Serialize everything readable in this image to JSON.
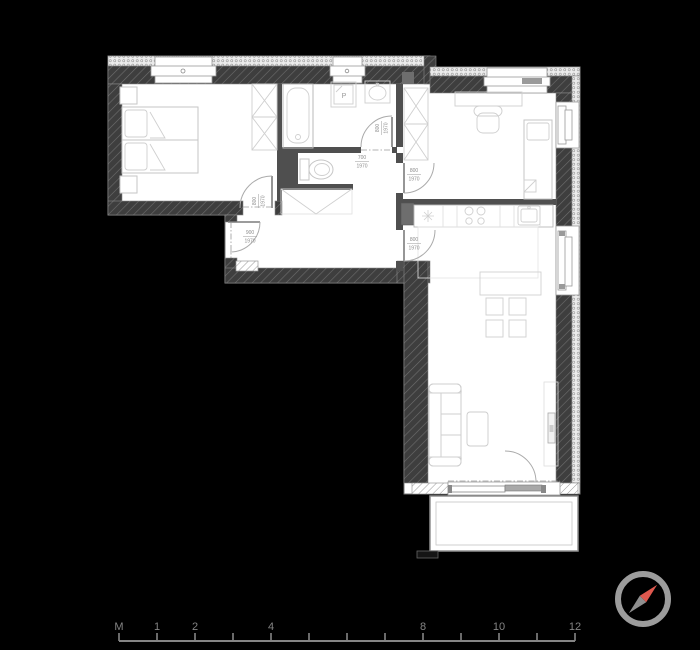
{
  "background": "#000000",
  "plan": {
    "wall_fill": "#3e3e3e",
    "partition_fill": "#4f4f4f",
    "duct_fill": "#6e6e6e",
    "washer_label": "P",
    "door_labels": [
      {
        "id": "bedroom-1-door",
        "width": "800",
        "height": "1970"
      },
      {
        "id": "entrance-door",
        "width": "900",
        "height": "1970"
      },
      {
        "id": "bathroom-door",
        "width": "800",
        "height": "1970"
      },
      {
        "id": "wc-niche-door",
        "width": "700",
        "height": "1970"
      },
      {
        "id": "bedroom-2-door",
        "width": "800",
        "height": "1970"
      },
      {
        "id": "living-room-door",
        "width": "800",
        "height": "1970"
      }
    ]
  },
  "compass": {
    "ring_color": "#9c9c9c",
    "north_needle_color": "#df584e",
    "south_needle_color": "#8f8f8f"
  },
  "ruler": {
    "color": "#848484",
    "labels": [
      "M",
      "1",
      "2",
      "4",
      "8",
      "10",
      "12"
    ]
  }
}
